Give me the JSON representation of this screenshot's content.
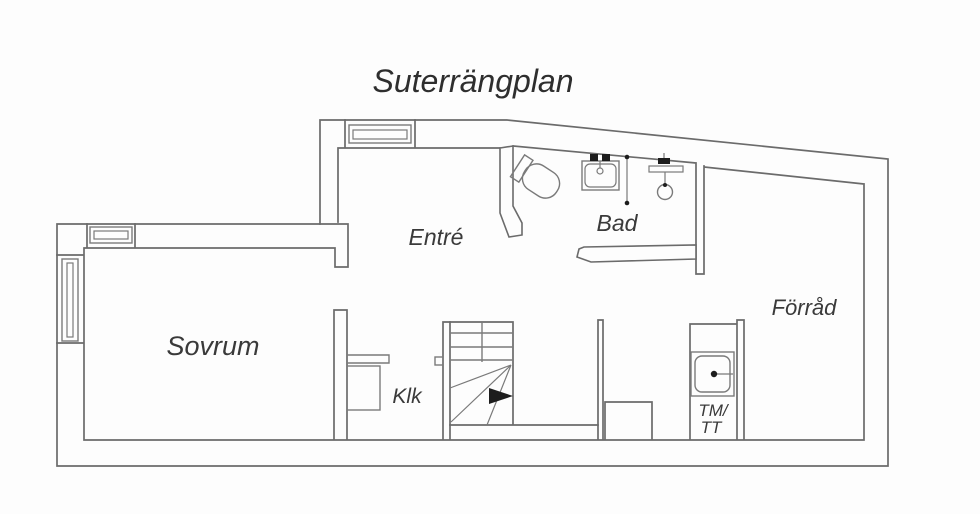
{
  "title": "Suterrängplan",
  "floor_plan": {
    "rooms": {
      "sovrum": "Sovrum",
      "entre": "Entré",
      "bad": "Bad",
      "forrad": "Förråd",
      "klk": "Klk",
      "tm_tt": {
        "line1": "TM/",
        "line2": "TT"
      }
    },
    "fixtures": [
      "toilet",
      "washbasin",
      "shower",
      "shower-screen",
      "laundry-sink",
      "winder-stairs",
      "wardrobe"
    ],
    "window_count": 3,
    "colors": {
      "wall": "#6b6b6b",
      "fixture": "#7a7a7a",
      "label_text": "#3a3a3a",
      "title_text": "#2e2e2e",
      "background": "#fdfdfd",
      "stairs_arrow": "#1d1d1d"
    }
  }
}
